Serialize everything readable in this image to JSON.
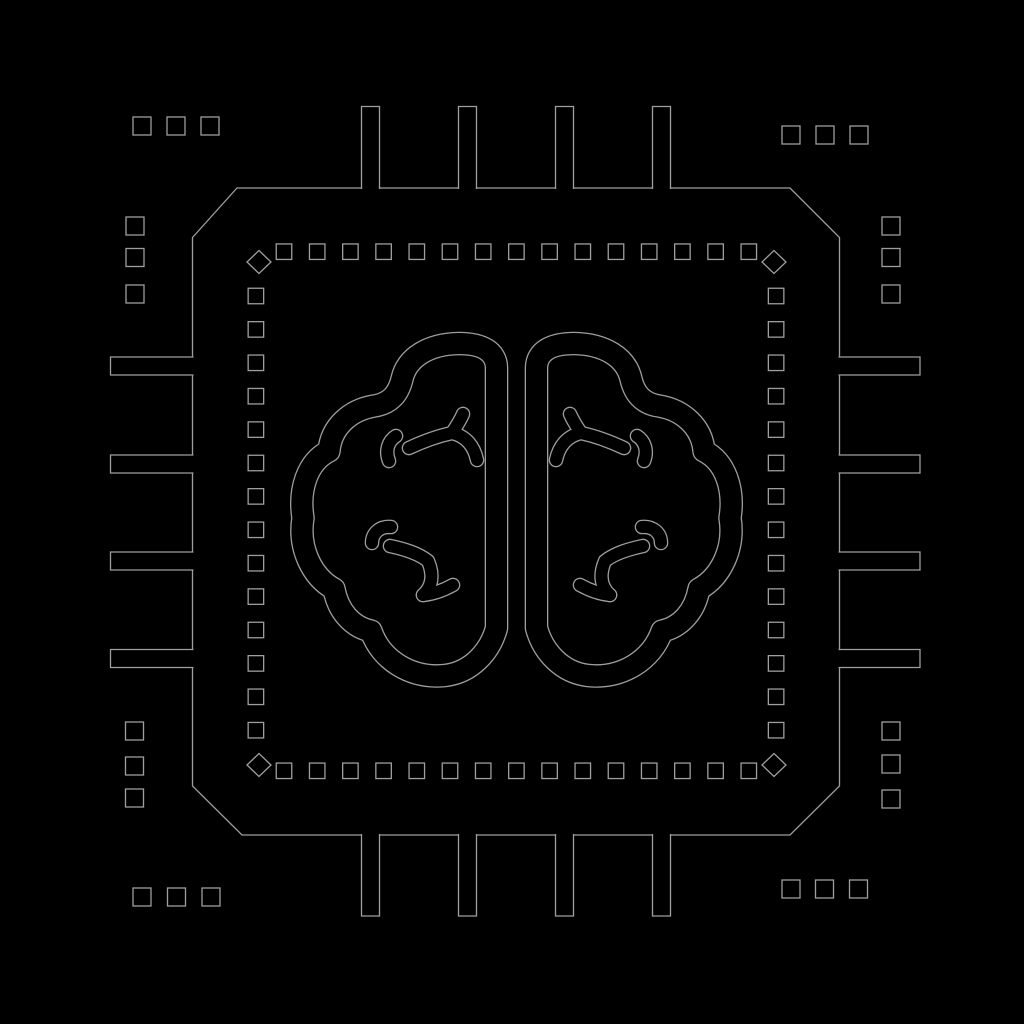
{
  "meta": {
    "width": 1024,
    "height": 1024,
    "description": "Black line-art icon of a microprocessor chip with a human brain in the center (AI chip), rendered as faint grey outlines on a black background"
  },
  "colors": {
    "background": "#000000",
    "line": "#9e9e9e",
    "fill": "#000000"
  },
  "icon": {
    "name": "ai-brain-chip-icon",
    "chip": {
      "shape": "octagon (square with chamfered corners)",
      "pins_per_side": 4,
      "sides": [
        "top",
        "right",
        "bottom",
        "left"
      ]
    },
    "dashed_border": {
      "dashes_per_horizontal_side": 15,
      "dashes_per_vertical_side": 14,
      "corner_markers": 4,
      "corner_marker_shape": "diamond"
    },
    "corner_clusters": {
      "count": 4,
      "squares_per_cluster": 6,
      "arrangement": "row of 3 + column of 3 small squares at each corner"
    },
    "brain": {
      "hemispheres": [
        "left",
        "right"
      ],
      "branch_details_per_hemisphere": 2
    }
  }
}
